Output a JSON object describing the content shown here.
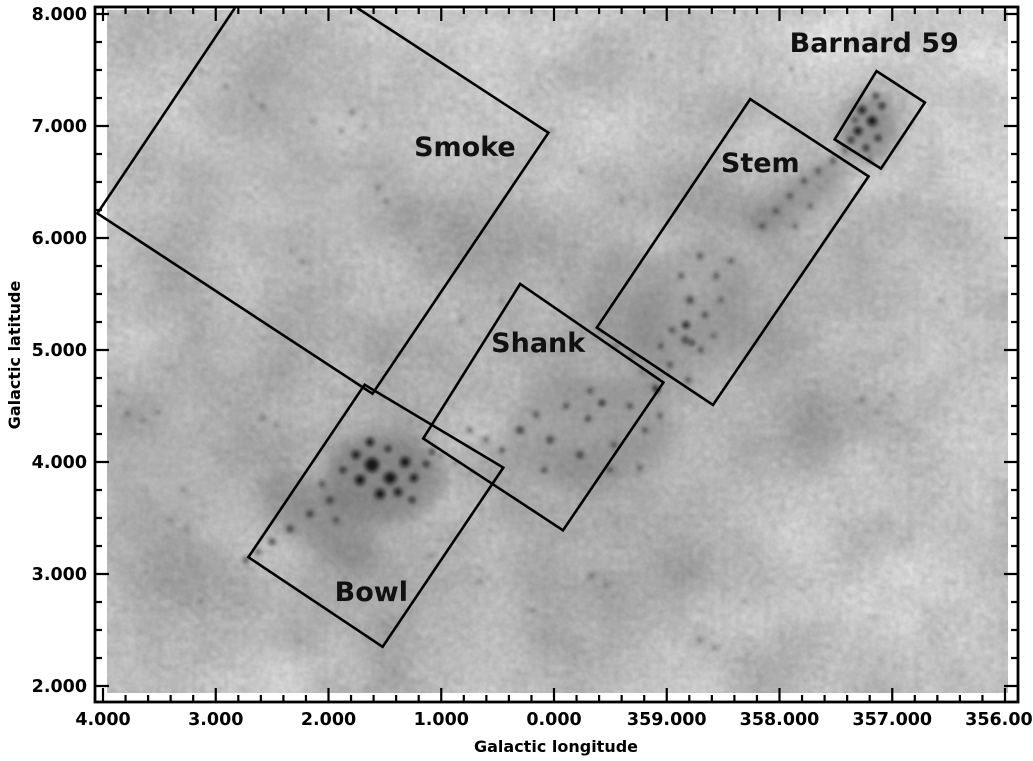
{
  "chart_data": {
    "type": "heatmap",
    "description": "Grayscale dust-extinction map of the Pipe Nebula region in Galactic coordinates, with five labelled survey fields outlined as rotated rectangles",
    "title": "",
    "xlabel": "Galactic longitude",
    "ylabel": "Galactic latitude",
    "grid": false,
    "x_axis": {
      "ticks": [
        {
          "label": "4.000",
          "value": 4
        },
        {
          "label": "3.000",
          "value": 3
        },
        {
          "label": "2.000",
          "value": 2
        },
        {
          "label": "1.000",
          "value": 1
        },
        {
          "label": "0.000",
          "value": 0
        },
        {
          "label": "359.000",
          "value": 359
        },
        {
          "label": "358.000",
          "value": 358
        },
        {
          "label": "357.000",
          "value": 357
        },
        {
          "label": "356.000",
          "value": 356
        }
      ],
      "range_deg": [
        4.07,
        355.89
      ],
      "minor_ticks_per_interval": 4
    },
    "y_axis": {
      "ticks": [
        {
          "label": "8.000",
          "value": 8
        },
        {
          "label": "7.000",
          "value": 7
        },
        {
          "label": "6.000",
          "value": 6
        },
        {
          "label": "5.000",
          "value": 5
        },
        {
          "label": "4.000",
          "value": 4
        },
        {
          "label": "3.000",
          "value": 3
        },
        {
          "label": "2.000",
          "value": 2
        }
      ],
      "range_deg": [
        1.86,
        8.06
      ],
      "minor_ticks_per_interval": 3
    },
    "regions": [
      {
        "name": "Smoke",
        "corners_lon_lat": [
          [
            4.05,
            6.22
          ],
          [
            2.5,
            8.55
          ],
          [
            0.05,
            6.94
          ],
          [
            1.61,
            4.61
          ]
        ],
        "label_lon_lat": [
          0.79,
          6.73
        ]
      },
      {
        "name": "Shank",
        "corners_lon_lat": [
          [
            0.3,
            5.59
          ],
          [
            359.03,
            4.71
          ],
          [
            359.92,
            3.39
          ],
          [
            1.16,
            4.21
          ]
        ],
        "label_lon_lat": [
          0.14,
          4.98
        ]
      },
      {
        "name": "Bowl",
        "corners_lon_lat": [
          [
            1.68,
            4.69
          ],
          [
            0.45,
            3.95
          ],
          [
            1.52,
            2.35
          ],
          [
            2.71,
            3.15
          ]
        ],
        "label_lon_lat": [
          1.62,
          2.76
        ]
      },
      {
        "name": "Stem",
        "corners_lon_lat": [
          [
            358.26,
            7.24
          ],
          [
            357.21,
            6.55
          ],
          [
            358.59,
            4.51
          ],
          [
            359.62,
            5.2
          ]
        ],
        "label_lon_lat": [
          358.17,
          6.59
        ]
      },
      {
        "name": "Barnard 59",
        "corners_lon_lat": [
          [
            357.14,
            7.49
          ],
          [
            356.71,
            7.21
          ],
          [
            357.1,
            6.62
          ],
          [
            357.51,
            6.88
          ]
        ],
        "label_lon_lat": [
          357.16,
          7.66
        ]
      }
    ]
  }
}
